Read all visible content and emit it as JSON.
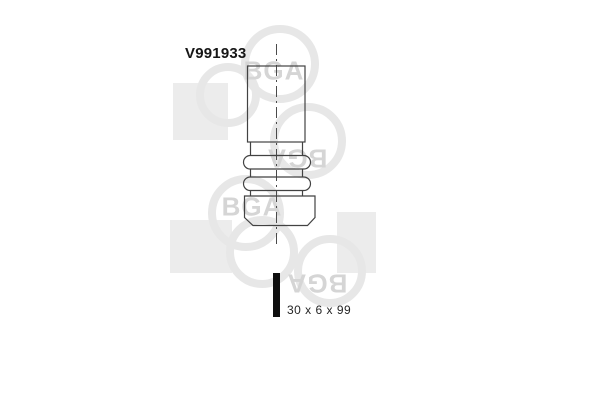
{
  "part": {
    "number": "V991933",
    "size_label": "30 x 6 x 99"
  },
  "watermark": {
    "brand": "BGA"
  },
  "drawing": {
    "subject": "engine-valve-line-drawing"
  },
  "colors": {
    "background": "#ffffff",
    "drawing_line": "#424242",
    "part_number_text": "#161616",
    "size_label_text": "#262626",
    "scale_bar": "#0e0e0e",
    "watermark_square": "#ececec",
    "watermark_ring": "#e7e7e7",
    "watermark_text": "#d5d5d5"
  }
}
